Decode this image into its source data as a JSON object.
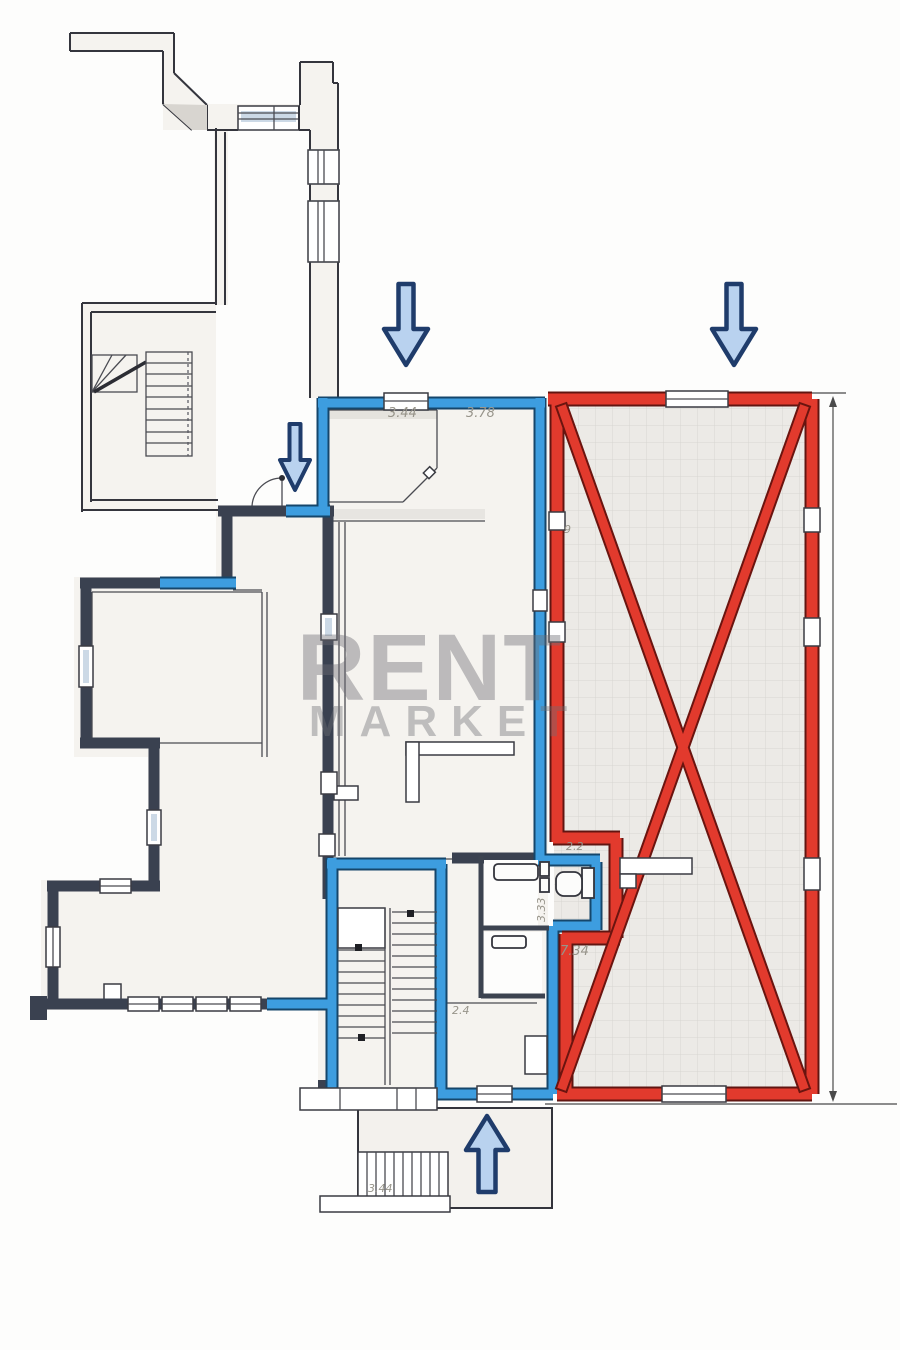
{
  "title": "apartment-floor-plan",
  "watermark": {
    "line1": "RENT",
    "line2": "MARKET"
  },
  "dimensions": {
    "room_top_left": "3.44",
    "room_top_right": "3.78",
    "note_small": "9",
    "wc_top": "2.2",
    "wc_side": "3.33",
    "hall_red": "7.34",
    "room_small": "2.4",
    "porch_stairs": "3.44"
  },
  "arrows": [
    {
      "id": "entrance-arrow-top-left",
      "direction": "down"
    },
    {
      "id": "entrance-arrow-top-right",
      "direction": "down"
    },
    {
      "id": "entrance-arrow-inner",
      "direction": "down"
    },
    {
      "id": "entrance-arrow-bottom",
      "direction": "up"
    }
  ],
  "colors": {
    "blue_wall": "#3d9ddf",
    "red_wall": "#e23a2d",
    "dark_wall": "#3a4150",
    "arrow_fill": "#b9d2ef",
    "arrow_stroke": "#1f3c6b",
    "tile_bg": "#eceae6",
    "tile_line": "#d7d6d1",
    "dim_text": "#97948a"
  }
}
